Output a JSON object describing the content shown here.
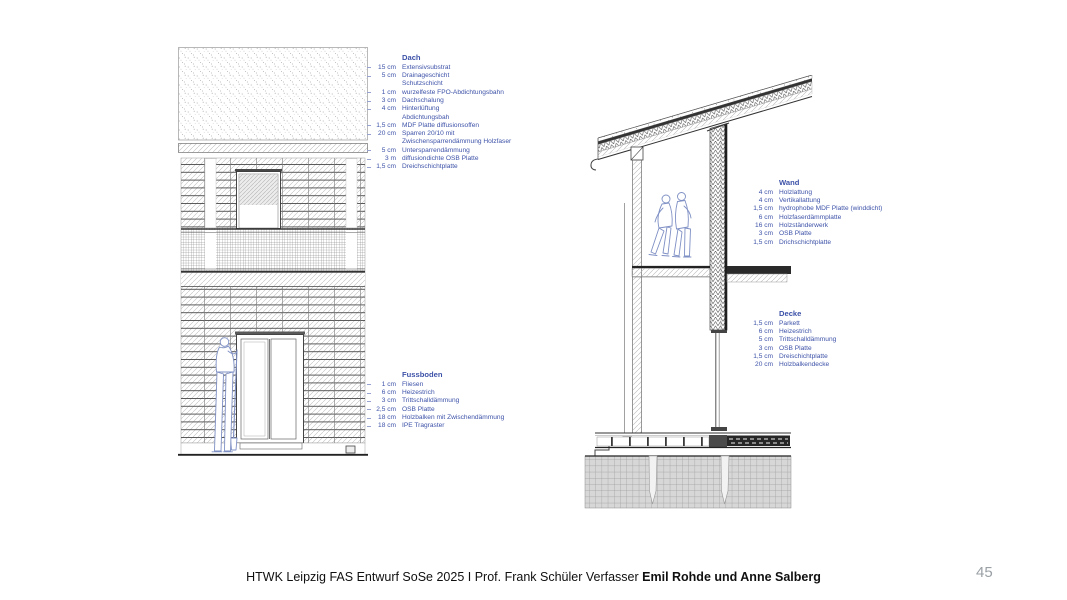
{
  "page": {
    "background": "#ffffff",
    "accent_color": "#3d52a8",
    "page_number": "45",
    "footer_text": "HTWK Leipzig FAS Entwurf SoSe 2025 I Prof. Frank Schüler  Verfasser ",
    "footer_authors": "Emil Rohde und Anne Salberg"
  },
  "layer_blocks": [
    {
      "title": "Dach",
      "ticks": true,
      "rows": [
        {
          "dim": "15 cm",
          "label": "Extensivsubstrat"
        },
        {
          "dim": "5 cm",
          "label": "Drainageschicht"
        },
        {
          "dim": "",
          "label": "Schutzschicht"
        },
        {
          "dim": "1 cm",
          "label": "wurzelfeste FPO-Abdichtungsbahn"
        },
        {
          "dim": "3 cm",
          "label": "Dachschalung"
        },
        {
          "dim": "4 cm",
          "label": "Hinterlüftung"
        },
        {
          "dim": "",
          "label": "Abdichtungsbah"
        },
        {
          "dim": "1,5 cm",
          "label": "MDF Platte diffusionsoffen"
        },
        {
          "dim": "20 cm",
          "label": "Sparren 20/10 mit"
        },
        {
          "dim": "",
          "label": "Zwischensparrendämmung Holzfaser"
        },
        {
          "dim": "5 cm",
          "label": "Untersparrendämmung"
        },
        {
          "dim": "3 m",
          "label": "diffusiondichte OSB Platte"
        },
        {
          "dim": "1,5 cm",
          "label": "Dreichschichtplatte"
        }
      ]
    },
    {
      "title": "Fussboden",
      "ticks": true,
      "rows": [
        {
          "dim": "1 cm",
          "label": "Fliesen"
        },
        {
          "dim": "6 cm",
          "label": "Heizestrich"
        },
        {
          "dim": "3 cm",
          "label": "Trittschalldämmung"
        },
        {
          "dim": "2,5 cm",
          "label": "OSB Platte"
        },
        {
          "dim": "18 cm",
          "label": "Holzbalken mit Zwischendämmung"
        },
        {
          "dim": "18 cm",
          "label": "IPE Tragraster"
        }
      ]
    },
    {
      "title": "Wand",
      "ticks": false,
      "rows": [
        {
          "dim": "4 cm",
          "label": "Holzlattung"
        },
        {
          "dim": "4 cm",
          "label": "Vertikallattung"
        },
        {
          "dim": "1,5 cm",
          "label": "hydrophobe MDF Platte (winddicht)"
        },
        {
          "dim": "6 cm",
          "label": "Holzfaserdämmplatte"
        },
        {
          "dim": "16 cm",
          "label": "Holzständerwerk"
        },
        {
          "dim": "3 cm",
          "label": "OSB Platte"
        },
        {
          "dim": "1,5 cm",
          "label": "Drichschichtplatte"
        }
      ]
    },
    {
      "title": "Decke",
      "ticks": false,
      "rows": [
        {
          "dim": "1,5 cm",
          "label": "Parkett"
        },
        {
          "dim": "6 cm",
          "label": "Heizestrich"
        },
        {
          "dim": "5 cm",
          "label": "Trittschalldämmung"
        },
        {
          "dim": "3 cm",
          "label": "OSB Platte"
        },
        {
          "dim": "1,5 cm",
          "label": "Dreischichtplatte"
        },
        {
          "dim": "20 cm",
          "label": "Holzbalkendecke"
        }
      ]
    }
  ]
}
